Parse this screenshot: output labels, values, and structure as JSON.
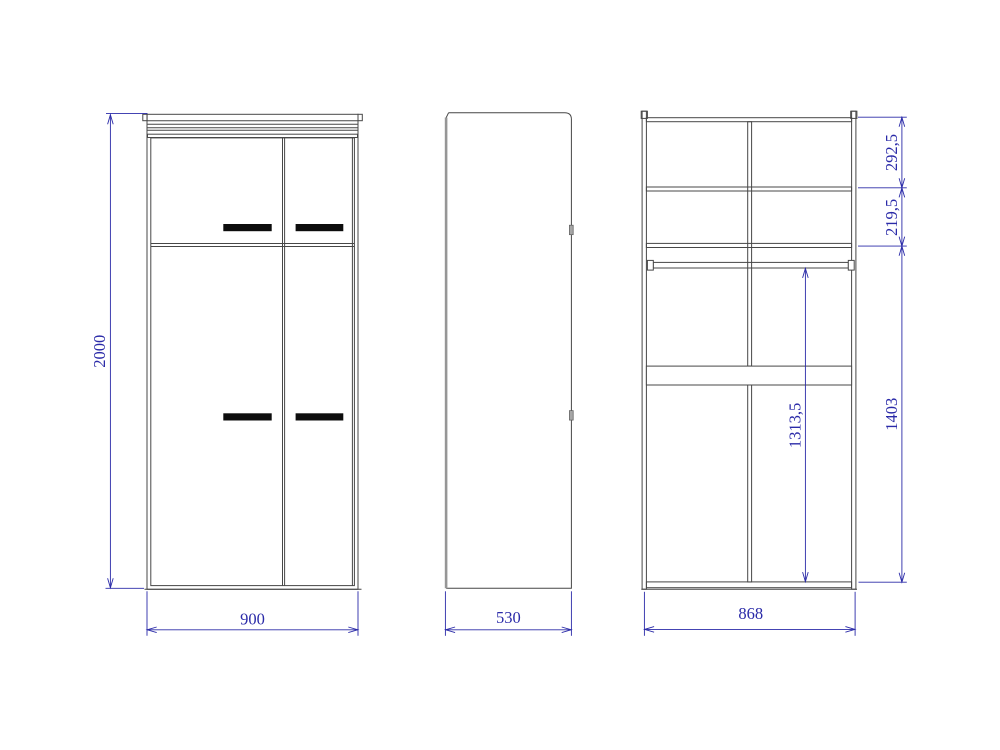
{
  "drawing": {
    "type": "wardrobe-orthographic-views",
    "colors": {
      "dimension_blue": "#2a2aa8",
      "line_gray": "#474747",
      "handle_black": "#0d0d0d"
    },
    "views": {
      "front": {
        "label_height": "2000",
        "label_width": "900"
      },
      "side": {
        "label_depth": "530"
      },
      "section": {
        "label_width": "868",
        "label_top_shelf_height": "292,5",
        "label_second_shelf_height": "219,5",
        "label_rod_to_bottom": "1313,5",
        "label_lower_compartment_height": "1403"
      }
    }
  }
}
